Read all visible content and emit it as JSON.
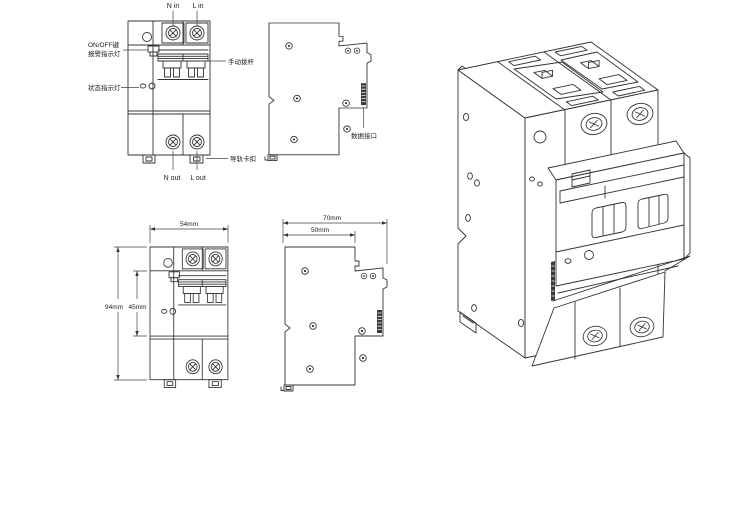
{
  "page": {
    "background": "#ffffff",
    "line_color": "#333333"
  },
  "views": {
    "front_annotated": {
      "top_terminal_labels": {
        "n_in": "N in",
        "l_in": "L in"
      },
      "bottom_terminal_labels": {
        "n_out": "N out",
        "l_out": "L out"
      },
      "callouts": {
        "on_off_button": "ON/OFF键",
        "alarm_indicator": "报警指示灯",
        "manual_lever": "手动拨杆",
        "status_indicator": "状态指示灯",
        "din_rail_clip": "导轨卡扣"
      }
    },
    "side_annotated": {
      "callouts": {
        "data_port": "数据接口"
      }
    },
    "front_dimensioned": {
      "dimensions": {
        "width": "54mm",
        "total_height": "94mm",
        "body_height": "45mm"
      }
    },
    "side_dimensioned": {
      "dimensions": {
        "total_depth": "70mm",
        "base_depth": "50mm"
      }
    }
  }
}
